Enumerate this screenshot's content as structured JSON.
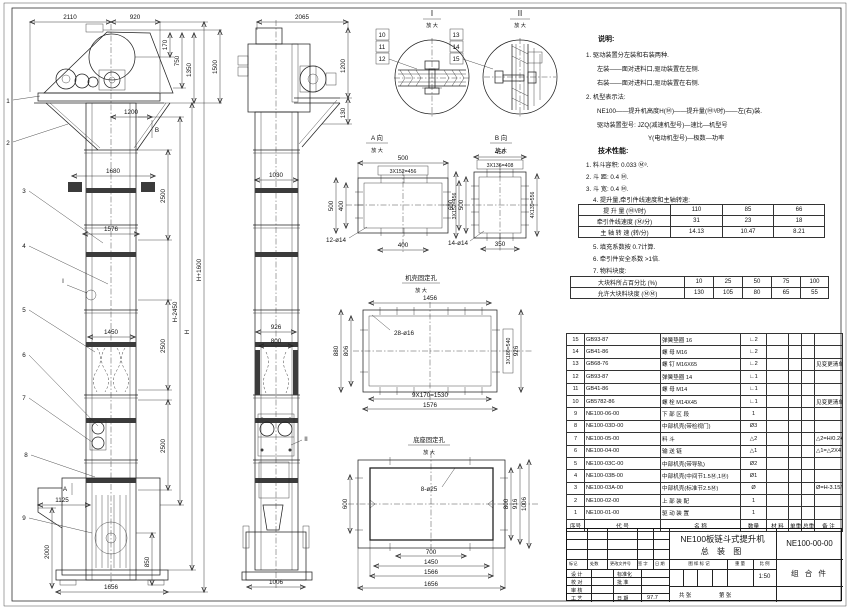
{
  "front_view": {
    "dims": {
      "top_left": "2110",
      "top_right": "920",
      "head_a": "170",
      "head_b": "750",
      "head_c": "1350",
      "head_d": "1500",
      "platform": "1200",
      "bracket_span": "1680",
      "section": "2500",
      "joint_width": "1576",
      "guide_width": "1450",
      "chute": "1125",
      "boot_height": "2000",
      "base_h": "850",
      "base_width": "1656",
      "h_minus": "H-2450",
      "h": "H",
      "h_plus": "H+1600"
    },
    "callouts": [
      "1",
      "2",
      "3",
      "4",
      "5",
      "6",
      "7",
      "8",
      "9"
    ],
    "marker_a": "A",
    "marker_b": "B",
    "marker_i": "I"
  },
  "side_view": {
    "dims": {
      "top": "2065",
      "head_h": "1200",
      "shelf": "130",
      "col_w": "1030",
      "guide_a": "926",
      "guide_b": "800",
      "base_w": "1006"
    },
    "marker_ii": "II"
  },
  "detail_i": {
    "label": "I",
    "scale": "放 大",
    "callouts": [
      "10",
      "11",
      "12"
    ]
  },
  "detail_ii": {
    "label": "II",
    "scale": "放 大",
    "callouts": [
      "13",
      "14",
      "15"
    ]
  },
  "view_a": {
    "label": "A 向",
    "scale": "放 大",
    "dims": {
      "top": "500",
      "pitch": "3X152=456",
      "left": "500",
      "left_in": "400",
      "right": "3X152=456",
      "bottom": "400",
      "holes": "12-ø14"
    }
  },
  "view_b": {
    "label": "B 向",
    "scale": "放 大",
    "dims": {
      "top": "450",
      "pitch": "3X136=408",
      "left": "600",
      "left_in": "500",
      "right": "4X139=556",
      "bottom": "350",
      "holes": "14-ø14"
    }
  },
  "casing_holes": {
    "label": "机壳固定孔",
    "scale": "放 大",
    "dims": {
      "top": "1456",
      "holes": "28-ø16",
      "left": "880",
      "left_in": "806",
      "right_pitch": "3X180=540",
      "right": "926",
      "bottom_pitch": "9X170=1530",
      "bottom": "1576"
    }
  },
  "base_holes": {
    "label": "底座固定孔",
    "scale": "放 大",
    "dims": {
      "holes": "8-ø25",
      "left": "600",
      "r1": "800",
      "r2": "916",
      "r3": "1006",
      "b1": "700",
      "b2": "1450",
      "b3": "1566",
      "b4": "1656"
    }
  },
  "notes": {
    "heading": "说明:",
    "items": [
      "1. 驱动装置分左装和右装两种.",
      "左装——面对进料口,驱动装置在左侧.",
      "右装——面对进料口,驱动装置在右侧.",
      "2. 机型表示法:",
      "NE100——提升机高度H(Ⓜ)——提升量(Ⓜ³/时)——左(右)装.",
      "驱动装置型号: JZQ(减速机型号)—速比—机型号",
      "Y(电动机型号)—极数—功率"
    ],
    "tech_heading": "技术性能:",
    "tech_items": [
      "1. 料斗容积: 0.033 Ⓜ³.",
      "2. 斗    距: 0.4 Ⓜ.",
      "3. 斗    宽: 0.4 Ⓜ.",
      "4. 提升量,牵引件线速度和主轴转速:",
      "5. 填充系数按 0.7计算.",
      "6. 牵引件安全系数 >1倍.",
      "7. 物料块度:"
    ]
  },
  "capacity_table": {
    "rows": [
      [
        "提 升 量 (Ⓜ³/时)",
        "110",
        "85",
        "66"
      ],
      [
        "牵引件线速度 (Ⓜ/分)",
        "31",
        "23",
        "18"
      ],
      [
        "主 轴 转 速 (转/分)",
        "14.13",
        "10.47",
        "8.21"
      ]
    ]
  },
  "lump_table": {
    "rows": [
      [
        "大块料所占百分比 (%)",
        "10",
        "25",
        "50",
        "75",
        "100"
      ],
      [
        "允许大块料块度 (ⓂⓂ)",
        "130",
        "105",
        "80",
        "65",
        "55"
      ]
    ]
  },
  "bom": {
    "headers": [
      "序号",
      "代  号",
      "名  称",
      "数量",
      "材 料",
      "单重",
      "总重",
      "备  注"
    ],
    "rows": [
      {
        "no": "15",
        "code": "GB93-87",
        "name": "弹簧垫圈  16",
        "qty": "∟2",
        "remark": ""
      },
      {
        "no": "14",
        "code": "GB41-86",
        "name": "螺  母  M16",
        "qty": "∟2",
        "remark": ""
      },
      {
        "no": "13",
        "code": "GB68-76",
        "name": "螺  钉  M16X65",
        "qty": "∟2",
        "remark": "见变更清单"
      },
      {
        "no": "12",
        "code": "GB93-87",
        "name": "弹簧垫圈  14",
        "qty": "∟1",
        "remark": ""
      },
      {
        "no": "11",
        "code": "GB41-86",
        "name": "螺  母  M14",
        "qty": "∟1",
        "remark": ""
      },
      {
        "no": "10",
        "code": "GB5782-86",
        "name": "螺  栓  M14X45",
        "qty": "∟1",
        "remark": "见变更清单"
      },
      {
        "no": "9",
        "code": "NE100-06-00",
        "name": "下 部 区 段",
        "qty": "1",
        "remark": ""
      },
      {
        "no": "8",
        "code": "NE100-03D-00",
        "name": "中部机壳(带检视门)",
        "qty": "Ø3",
        "remark": ""
      },
      {
        "no": "7",
        "code": "NE100-05-00",
        "name": "料  斗",
        "qty": "△2",
        "remark": "△2=H/0.2+5.75"
      },
      {
        "no": "6",
        "code": "NE100-04-00",
        "name": "输 送 链",
        "qty": "△1",
        "remark": "△1=△2X4"
      },
      {
        "no": "5",
        "code": "NE100-03C-00",
        "name": "中部机壳(带导轨)",
        "qty": "Ø2",
        "remark": ""
      },
      {
        "no": "4",
        "code": "NE100-03B-00",
        "name": "中部机壳(中间节1.5Ⓜ,1Ⓜ)",
        "qty": "Ø1",
        "remark": ""
      },
      {
        "no": "3",
        "code": "NE100-03A-00",
        "name": "中部机壳(标准节2.5Ⓜ)",
        "qty": "Ø",
        "remark": "Ø=H-3.15/2.5"
      },
      {
        "no": "2",
        "code": "NE100-02-00",
        "name": "上 部 装 配",
        "qty": "1",
        "remark": ""
      },
      {
        "no": "1",
        "code": "NE100-01-00",
        "name": "驱 动 装 置",
        "qty": "1",
        "remark": ""
      }
    ]
  },
  "title_block": {
    "product": "NE100板链斗式提升机",
    "sheet_name": "总  装  图",
    "code": "NE100-00-00",
    "part_type": "组 合 件",
    "rev_cols": [
      "标记",
      "处数",
      "更改文件号",
      "签 字",
      "日 期"
    ],
    "role1": "设 计",
    "role2": "校 对",
    "role3": "审 核",
    "role4": "工 艺",
    "aux1": "标准化",
    "aux2": "批 准",
    "aux4": "日 期",
    "date": "97.7",
    "stamp1": "图 样 标 记",
    "stamp2": "重 量",
    "stamp3": "比 例",
    "scale": "1:50",
    "sheets_total": "共  张",
    "sheets_no": "第  张"
  }
}
